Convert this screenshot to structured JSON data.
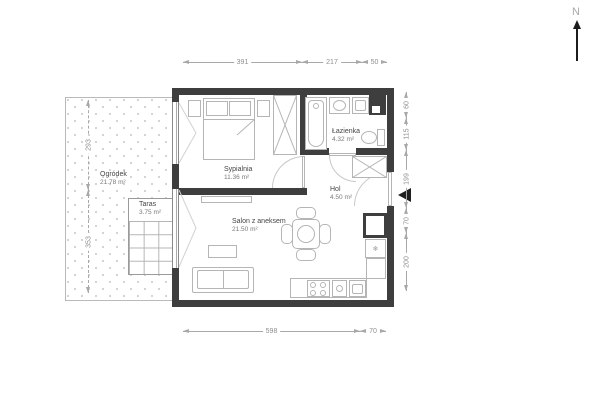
{
  "plan": {
    "north_label": "N",
    "rooms": {
      "ogrodek": {
        "name": "Ogródek",
        "area": "21.78 m²"
      },
      "taras": {
        "name": "Taras",
        "area": "3.75 m²"
      },
      "sypialnia": {
        "name": "Sypialnia",
        "area": "11.36 m²"
      },
      "lazienka": {
        "name": "Łazienka",
        "area": "4.32 m²"
      },
      "hol": {
        "name": "Hol",
        "area": "4.50 m²"
      },
      "salon": {
        "name": "Salon z aneksem",
        "area": "21.50 m²"
      }
    },
    "dimensions": {
      "top": [
        "391",
        "217",
        "50"
      ],
      "bottom": [
        "598",
        "70"
      ],
      "left": [
        "293",
        "353"
      ],
      "right": [
        "60",
        "115",
        "199",
        "70",
        "200"
      ]
    },
    "icons": {
      "fridge": "❄",
      "entrance_marker": "left-pointing-triangle"
    },
    "colors": {
      "wall": "#3e3e3e",
      "furniture": "#b5b5b5",
      "dimension": "#8f8f8f"
    }
  }
}
